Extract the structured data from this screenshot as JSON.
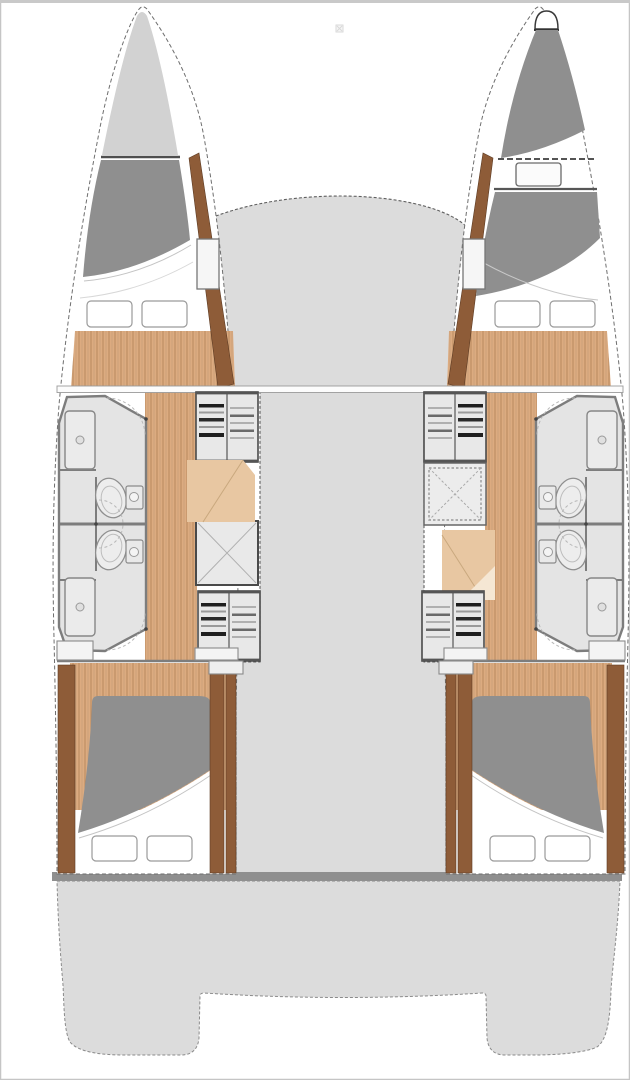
{
  "page": {
    "title": "Catamaran four-cabin four-head layout — overhead deck plan"
  },
  "colors": {
    "background": "#ffffff",
    "frame": "#c5c5c5",
    "deck": "#dcdcdc",
    "deck_outline": "#5f5f5f",
    "hull_fill": "#ffffff",
    "hull_outline": "#6e6e6e",
    "bow_locker": "#d2d2d2",
    "berth": "#8f8f8f",
    "mattress": "#ffffff",
    "pillow": "#ffffff",
    "pillow_outline": "#9a9a9a",
    "wood": "#dcab80",
    "wood_stripe": "#b9895e",
    "seat_wood": "#e8c7a2",
    "trim": "#8e5c38",
    "bath_floor": "#e4e4e4",
    "bath_wall": "#7d7d7d",
    "fixture_fill": "#ececec",
    "fixture_line": "#8a8a8a",
    "stairs_box": "#e8e8e8",
    "step_dark": "#1f1f1f",
    "step_mid": "#9a9a9a",
    "transom_bar": "#8f8f8f",
    "arc": "#b8b8b8",
    "artifact": "#d9d9d9"
  },
  "vessel": {
    "view": "deck-plan",
    "hulls": [
      {
        "side": "port",
        "compartments": [
          "bow-locker",
          "forward-double-berth",
          "forward-head-with-shower",
          "aft-head-with-shower",
          "companionway-steps-forward",
          "storage-hatch",
          "companionway-steps-aft",
          "aft-double-berth"
        ]
      },
      {
        "side": "starboard",
        "compartments": [
          "forepeak-berth-with-hatch",
          "forward-double-berth",
          "forward-head-with-shower",
          "aft-head-with-shower",
          "companionway-steps-forward",
          "storage-hatch-dashed",
          "companionway-steps-aft",
          "aft-double-berth"
        ]
      }
    ],
    "deck_areas": [
      "foredeck-bridgedeck",
      "central-corridor",
      "aft-crossbeam",
      "cockpit-platform",
      "port-transom",
      "starboard-transom"
    ]
  }
}
